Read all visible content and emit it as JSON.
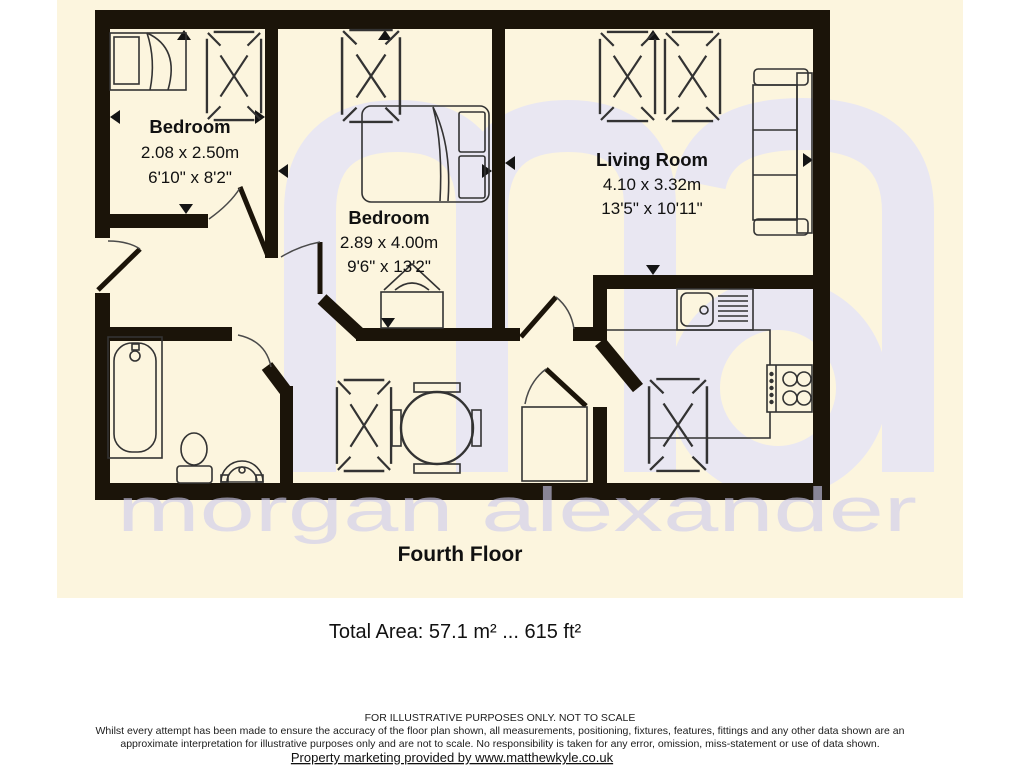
{
  "floorplan": {
    "floor_label": "Fourth Floor",
    "total_area": "Total Area: 57.1 m² ... 615 ft²",
    "rooms": [
      {
        "name": "Bedroom",
        "dim_m": "2.08 x 2.50m",
        "dim_ft": "6'10\" x 8'2\""
      },
      {
        "name": "Bedroom",
        "dim_m": "2.89 x 4.00m",
        "dim_ft": "9'6\" x 13'2\""
      },
      {
        "name": "Living Room",
        "dim_m": "4.10 x 3.32m",
        "dim_ft": "13'5\" x 10'11\""
      }
    ],
    "watermark": {
      "logo": "ma",
      "name": "morgan alexander"
    },
    "colors": {
      "background_cream": "#fcf5de",
      "wall_black": "#1b1409",
      "watermark_logo": "#e9e7f2",
      "watermark_text": "#d7d6ee"
    }
  },
  "footer": {
    "disclaimer_line1": "FOR ILLUSTRATIVE PURPOSES ONLY. NOT TO SCALE",
    "disclaimer_line2": "Whilst every attempt has been made to ensure the accuracy of the floor plan shown, all measurements, positioning, fixtures, features, fittings and any other data shown are an",
    "disclaimer_line3": "approximate interpretation for illustrative purposes only and are not to scale. No responsibility is taken for any error, omission, miss-statement or use of data shown.",
    "marketing_line": "Property marketing provided by www.matthewkyle.co.uk"
  }
}
